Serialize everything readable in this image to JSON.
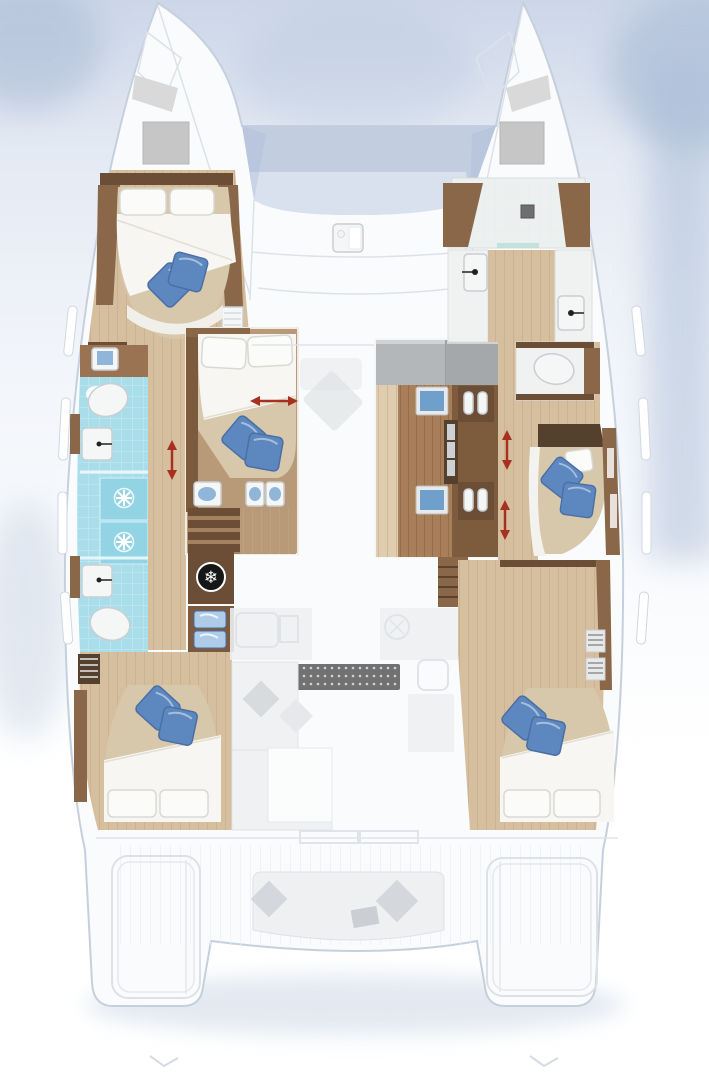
{
  "figure": {
    "type": "floorplan",
    "subject": "catamaran-yacht-interior-layout",
    "features": [
      "trampoline",
      "forward-cockpit",
      "port-forward-cabin",
      "port-shower-room",
      "port-aft-head",
      "port-aft-cabin",
      "center-forward-berth",
      "galley-block",
      "salon-faded-overlay",
      "starboard-vanity",
      "starboard-shower-room",
      "starboard-toilet-room",
      "starboard-mid-cabin",
      "starboard-aft-cabin",
      "aft-cockpit",
      "port-swim-platform",
      "starboard-swim-platform",
      "companionway-stairs",
      "sliding-arrows"
    ]
  },
  "icons": {
    "ac_snowflake": "❄"
  },
  "colors": {
    "page_top": "#ccd6e8",
    "page_mid": "#e4eaf3",
    "page_soft": "#f2f5fa",
    "hull_white": "#fafbfc",
    "hull_edge": "#c6d0dd",
    "deck_line": "#dde2e9",
    "deck_plank": "#e9edf1",
    "shadow_blue": "#a9bbd6",
    "shadow_soft": "#cdd8e6",
    "tramp": "#c2cde0",
    "tramp_light": "#dde4f0",
    "wood_floor": "#d5bf9f",
    "wood_floor_light": "#e0cdb0",
    "plank_line": "#c2a987",
    "wood_mid": "#b99a78",
    "wood_trim": "#8a6748",
    "wood_dark": "#6b4e35",
    "wood_deep": "#55402d",
    "galley_floor": "#a87f58",
    "galley_plank": "#8f6a47",
    "counter_gray": "#b4b7b9",
    "counter_gray2": "#a5a8ab",
    "bed_beige": "#d7c7ab",
    "bed_white": "#f7f6f2",
    "pillow_white": "#fbfbfa",
    "pillow_edge": "#d9d9d4",
    "pillow_blue": "#5d88bf",
    "pillow_blue_dark": "#4a6fa5",
    "aqua": "#a9dde9",
    "aqua_dark": "#93d4e4",
    "aqua_grout": "#d4f0f6",
    "fixture_white": "#f5f6f6",
    "fixture_edge": "#c9ced2",
    "blue_fixture": "#8fb5d8",
    "drawer_blue": "#aecbe8",
    "arrow_red": "#a83021",
    "faded_fill": "#eef0f2",
    "faded_edge": "#dde1e6",
    "faded_dark": "#d3d7db",
    "mat_dark": "#474747",
    "mat_dot": "#cfcfcf",
    "icon_dark": "#161616",
    "gray_hatch": "#c6c6c6",
    "gray_panel": "#d9d9d9",
    "drain_gray": "#6f6f6f"
  }
}
